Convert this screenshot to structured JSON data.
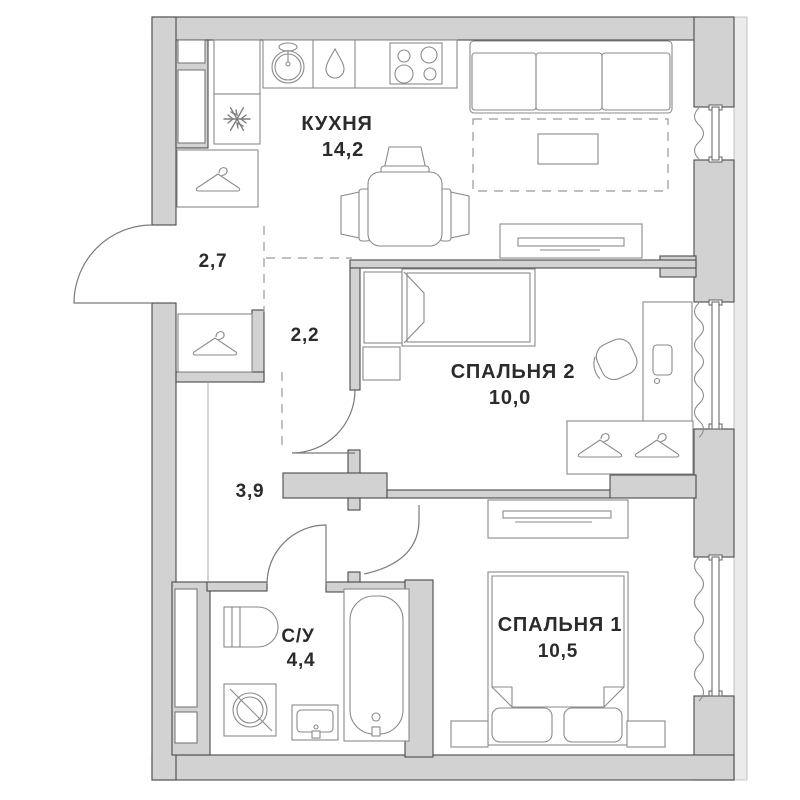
{
  "plan": {
    "type": "apartment-floor-plan",
    "rooms": [
      {
        "id": "kitchen",
        "name": "КУХНЯ",
        "area": "14,2"
      },
      {
        "id": "hallway",
        "name": "",
        "area": "2,7"
      },
      {
        "id": "corridor-upper",
        "name": "",
        "area": "2,2"
      },
      {
        "id": "bedroom-2",
        "name": "СПАЛЬНЯ 2",
        "area": "10,0"
      },
      {
        "id": "corridor-lower",
        "name": "",
        "area": "3,9"
      },
      {
        "id": "bathroom",
        "name": "С/У",
        "area": "4,4"
      },
      {
        "id": "bedroom-1",
        "name": "СПАЛЬНЯ 1",
        "area": "10,5"
      }
    ],
    "icons": [
      "snowflake-fridge",
      "hanger",
      "sink",
      "water-drop",
      "stove-burners",
      "washing-machine",
      "toilet",
      "bathtub",
      "wash-basin",
      "curtain-wave"
    ],
    "colors": {
      "wall": "#d2d2d2",
      "wall_stroke": "#4a4a4a",
      "furniture_stroke": "#8a8a8a",
      "dashed_line": "#9a9a9a",
      "label_text": "#2b2b2b",
      "background": "#ffffff"
    }
  }
}
